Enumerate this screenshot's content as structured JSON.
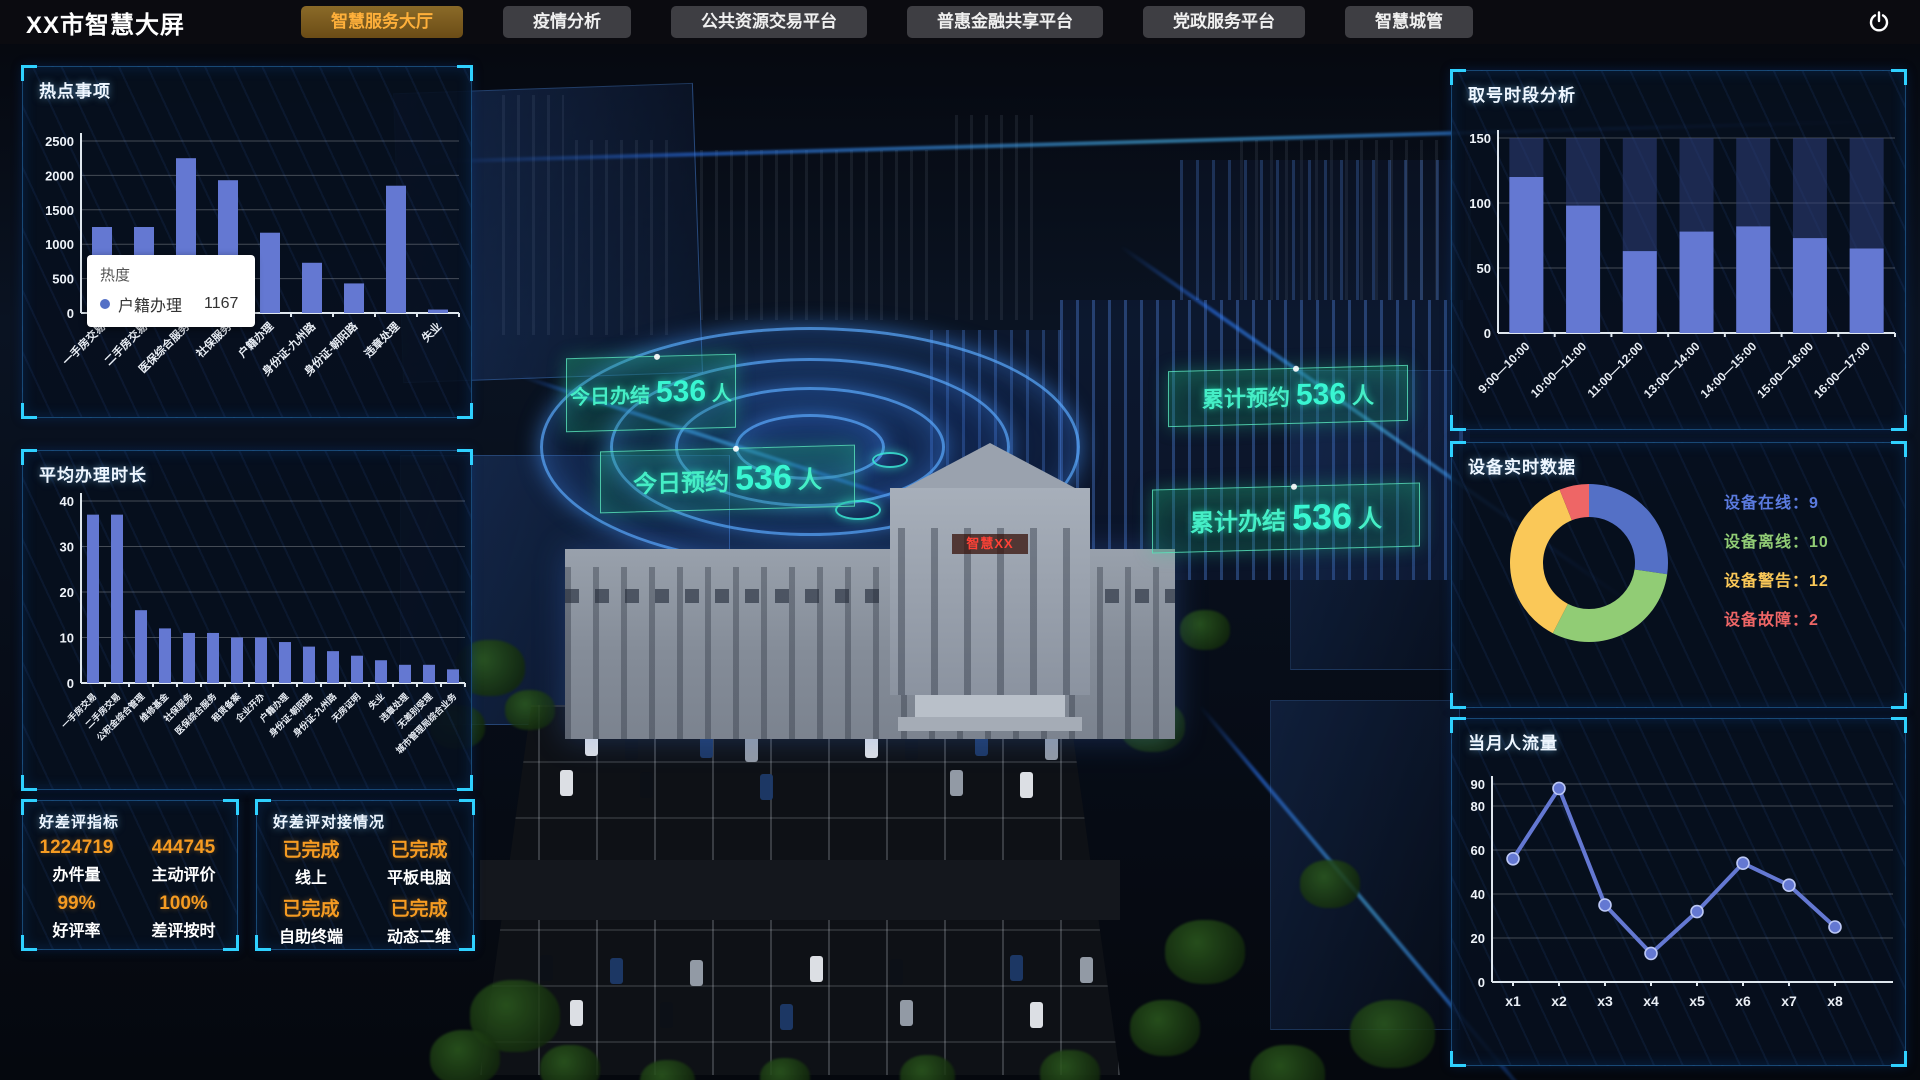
{
  "app": {
    "title": "XX市智慧大屏"
  },
  "nav": {
    "tabs": [
      {
        "label": "智慧服务大厅",
        "active": true
      },
      {
        "label": "疫情分析",
        "active": false
      },
      {
        "label": "公共资源交易平台",
        "active": false
      },
      {
        "label": "普惠金融共享平台",
        "active": false
      },
      {
        "label": "党政服务平台",
        "active": false
      },
      {
        "label": "智慧城管",
        "active": false
      }
    ],
    "power_icon": "power-icon"
  },
  "overlays": {
    "building_sign": "智慧XX",
    "tags": [
      {
        "label": "今日办结",
        "value": "536",
        "unit": "人"
      },
      {
        "label": "今日预约",
        "value": "536",
        "unit": "人"
      },
      {
        "label": "累计预约",
        "value": "536",
        "unit": "人"
      },
      {
        "label": "累计办结",
        "value": "536",
        "unit": "人"
      }
    ]
  },
  "panels": {
    "hot_items": {
      "title": "热点事项",
      "tooltip": {
        "title": "热度",
        "series": "户籍办理",
        "value": "1167"
      }
    },
    "avg_time": {
      "title": "平均办理时长"
    },
    "rating_metrics": {
      "title": "好差评指标",
      "items": [
        {
          "value": "1224719",
          "label": "办件量"
        },
        {
          "value": "444745",
          "label": "主动评价"
        },
        {
          "value": "99%",
          "label": "好评率"
        },
        {
          "value": "100%",
          "label": "差评按时"
        }
      ]
    },
    "rating_status": {
      "title": "好差评对接情况",
      "items": [
        {
          "value": "已完成",
          "label": "线上"
        },
        {
          "value": "已完成",
          "label": "平板电脑"
        },
        {
          "value": "已完成",
          "label": "自助终端"
        },
        {
          "value": "已完成",
          "label": "动态二维"
        }
      ]
    },
    "queue_analysis": {
      "title": "取号时段分析"
    },
    "device_data": {
      "title": "设备实时数据",
      "legend": [
        {
          "label": "设备在线",
          "value": "9",
          "color": "#5b7be0"
        },
        {
          "label": "设备离线",
          "value": "10",
          "color": "#91cc75"
        },
        {
          "label": "设备警告",
          "value": "12",
          "color": "#fac858"
        },
        {
          "label": "设备故障",
          "value": "2",
          "color": "#ee6666"
        }
      ]
    },
    "monthly_traffic": {
      "title": "当月人流量"
    }
  },
  "chart_data": [
    {
      "id": "hot_items",
      "type": "bar",
      "title": "热点事项",
      "categories": [
        "一手房交易",
        "二手房交易",
        "医保综合服务",
        "社保服务",
        "户籍办理",
        "身份证-九州路",
        "身份证-朝阳路",
        "违章处理",
        "失业"
      ],
      "values": [
        1250,
        1250,
        2250,
        1930,
        1167,
        730,
        430,
        1850,
        50
      ],
      "ylim": [
        0,
        2500
      ],
      "yticks": [
        0,
        500,
        1000,
        1500,
        2000,
        2500
      ],
      "bar_color": "#6478d2",
      "grid": true,
      "xlabel": "",
      "ylabel": ""
    },
    {
      "id": "avg_time",
      "type": "bar",
      "title": "平均办理时长",
      "categories": [
        "一手房交易",
        "二手房交易",
        "公积金综合管理",
        "维修基金",
        "社保服务",
        "医保综合服务",
        "租赁备案",
        "企业开办",
        "户籍办理",
        "身份证-朝阳路",
        "身份证-九州路",
        "无房证明",
        "失业",
        "违章处理",
        "无差别受理",
        "城市管理局综合业务"
      ],
      "values": [
        37,
        37,
        16,
        12,
        11,
        11,
        10,
        10,
        9,
        8,
        7,
        6,
        5,
        4,
        4,
        3
      ],
      "ylim": [
        0,
        40
      ],
      "yticks": [
        0,
        10,
        20,
        30,
        40
      ],
      "bar_color": "#6478d2",
      "grid": true,
      "xlabel": "",
      "ylabel": ""
    },
    {
      "id": "queue_analysis",
      "type": "bar",
      "title": "取号时段分析",
      "categories": [
        "9:00—10:00",
        "10:00—11:00",
        "11:00—12:00",
        "13:00—14:00",
        "14:00—15:00",
        "15:00—16:00",
        "16:00—17:00"
      ],
      "values": [
        120,
        98,
        63,
        78,
        82,
        73,
        65
      ],
      "background_value": 150,
      "ylim": [
        0,
        150
      ],
      "yticks": [
        0,
        50,
        100,
        150
      ],
      "bar_color": "#6478d2",
      "bg_bar_color": "rgba(47,64,122,0.55)",
      "grid": true
    },
    {
      "id": "device_data",
      "type": "pie",
      "title": "设备实时数据",
      "donut": true,
      "labels": [
        "设备在线",
        "设备离线",
        "设备警告",
        "设备故障"
      ],
      "values": [
        9,
        10,
        12,
        2
      ],
      "colors": [
        "#5470c6",
        "#91cc75",
        "#fac858",
        "#ee6666"
      ],
      "legend_position": "right"
    },
    {
      "id": "monthly_traffic",
      "type": "line",
      "title": "当月人流量",
      "categories": [
        "x1",
        "x2",
        "x3",
        "x4",
        "x5",
        "x6",
        "x7",
        "x8"
      ],
      "values": [
        56,
        88,
        35,
        13,
        32,
        54,
        44,
        25
      ],
      "ylim": [
        0,
        90
      ],
      "yticks": [
        0,
        20,
        40,
        60,
        80,
        90
      ],
      "line_color": "#6478d2",
      "grid": true
    }
  ]
}
